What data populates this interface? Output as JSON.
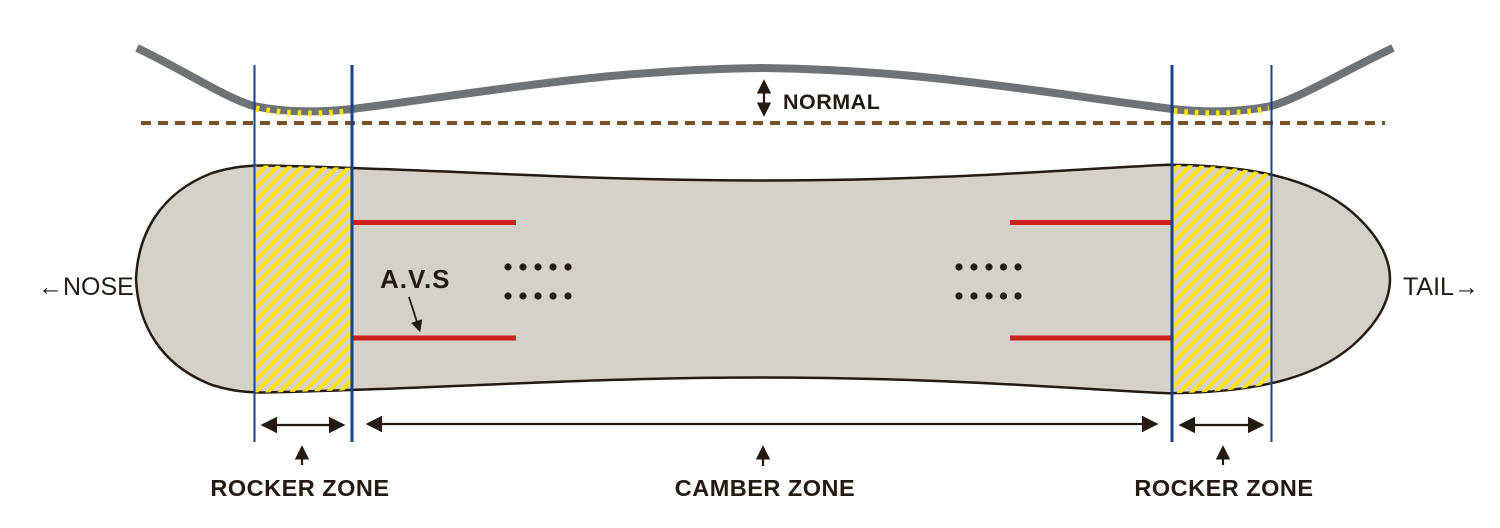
{
  "diagram": {
    "title_hint": "Snowboard camber profile diagram",
    "side_profile": {
      "normal_label": "NORMAL"
    },
    "board": {
      "nose_label": "←NOSE",
      "tail_label": "TAIL→",
      "avs_label": "A.V.S",
      "insert_rows_per_group": 2,
      "insert_dots_per_row": 5
    },
    "zones": {
      "rocker_left_label": "ROCKER ZONE",
      "camber_label": "CAMBER ZONE",
      "rocker_right_label": "ROCKER ZONE"
    }
  },
  "colors": {
    "board_fill": "#d6d1c8",
    "outline": "#241b13",
    "hatch_yellow": "#ffe400",
    "zone_line_blue": "#16418c",
    "insert_red": "#cb1f1c",
    "profile_gray": "#6e7378",
    "baseline_brown": "#7b5126",
    "ink": "#231a12"
  }
}
